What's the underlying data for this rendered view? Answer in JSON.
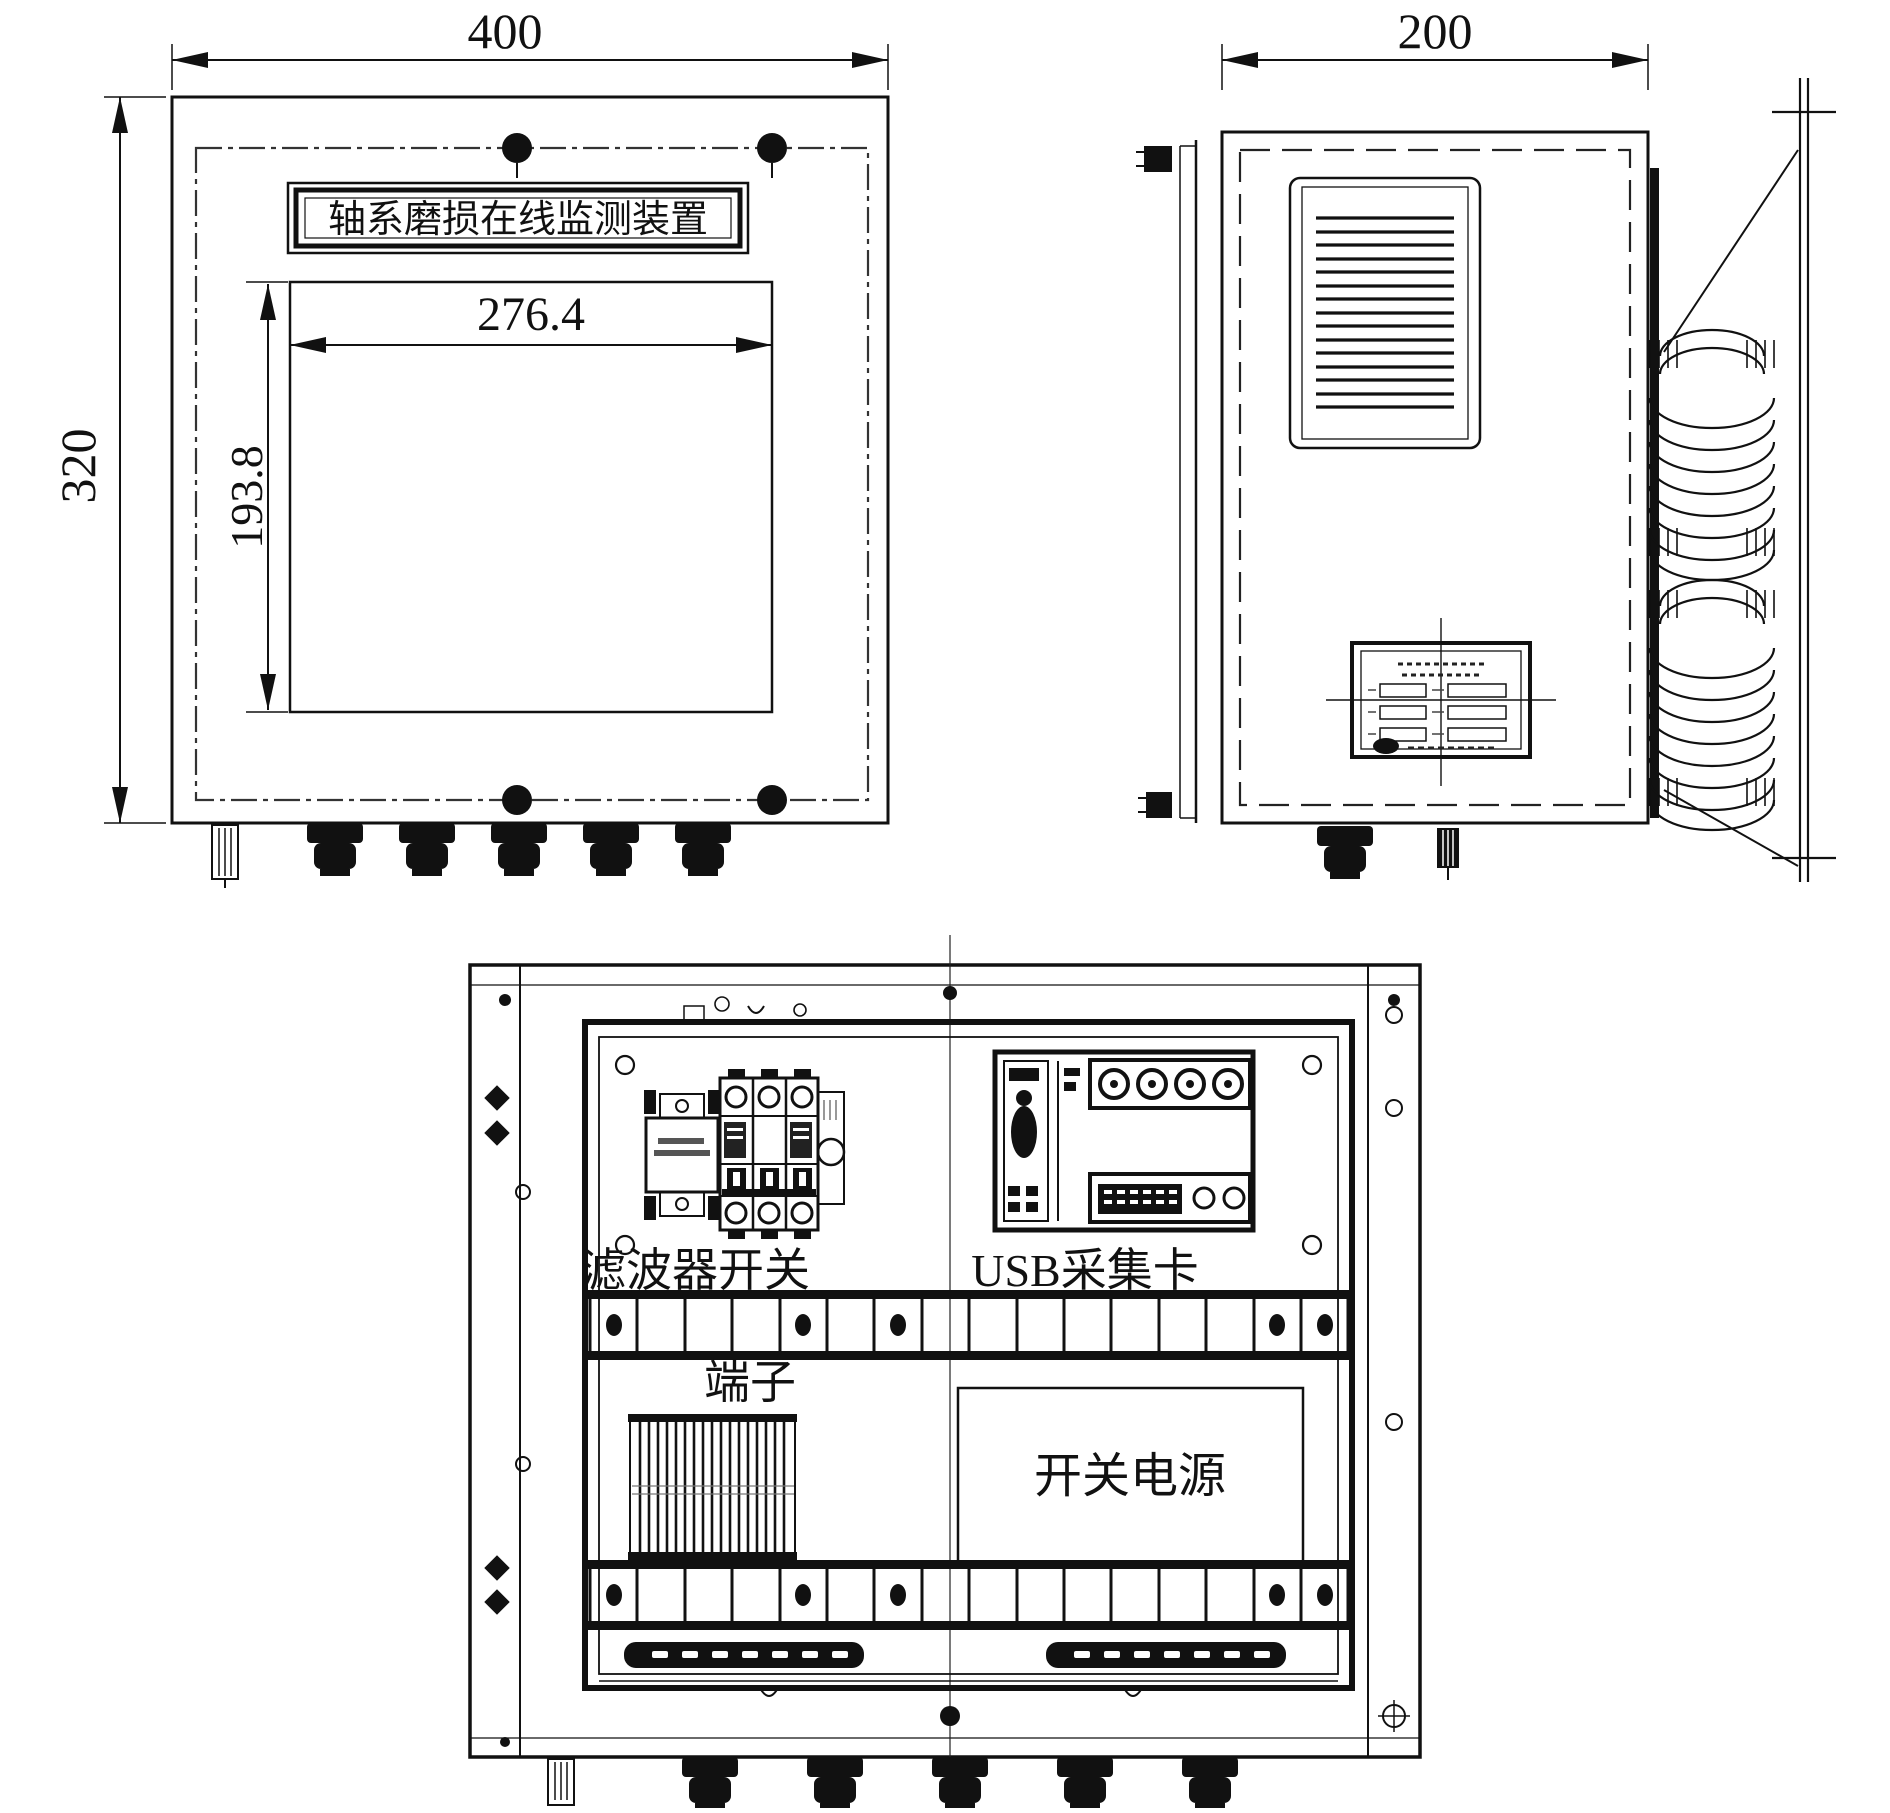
{
  "front_view": {
    "nameplate_text": "轴系磨损在线监测装置",
    "width_mm": "400",
    "height_mm": "320",
    "screen_width_mm": "276.4",
    "screen_height_mm": "193.8"
  },
  "side_view": {
    "depth_mm": "200"
  },
  "internal_view": {
    "filter_switch_label": "滤波器开关",
    "usb_card_label": "USB采集卡",
    "terminal_label": "端子",
    "power_supply_label": "开关电源"
  },
  "colors": {
    "line": "#111111",
    "background": "#ffffff"
  }
}
